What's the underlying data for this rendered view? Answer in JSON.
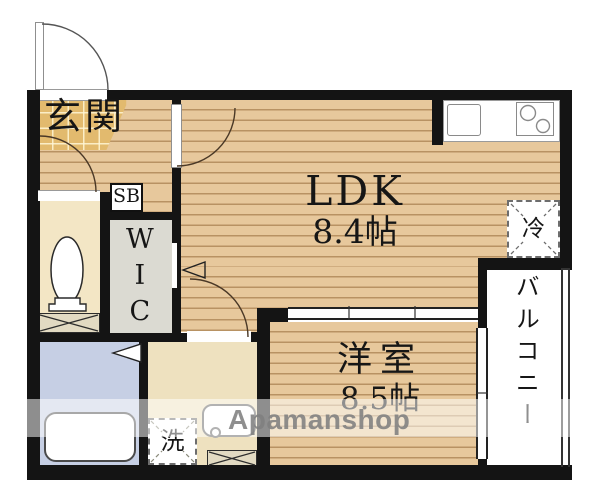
{
  "floorplan": {
    "entrance": {
      "label": "玄関"
    },
    "ldk": {
      "label": "LDK",
      "size": "8.4帖"
    },
    "western_room": {
      "label": "洋室",
      "size": "8.5帖"
    },
    "wic": {
      "label": "WIC"
    },
    "shoe_box": {
      "label": "SB"
    },
    "refrigerator": {
      "label": "冷"
    },
    "balcony": {
      "label": "バルコニー"
    },
    "washer": {
      "label": "洗"
    },
    "watermark": {
      "text": "Apamanshop"
    },
    "colors": {
      "wood_floor": "#e7c89c",
      "entrance_tile": "#e2ba6e",
      "toilet_room": "#f3e6c5",
      "wic_room": "#dbdad2",
      "bathroom": "#c6cfe4",
      "washroom": "#eee1bf",
      "wall": "#141414",
      "watermark_gray": "#8a8a8a"
    }
  }
}
